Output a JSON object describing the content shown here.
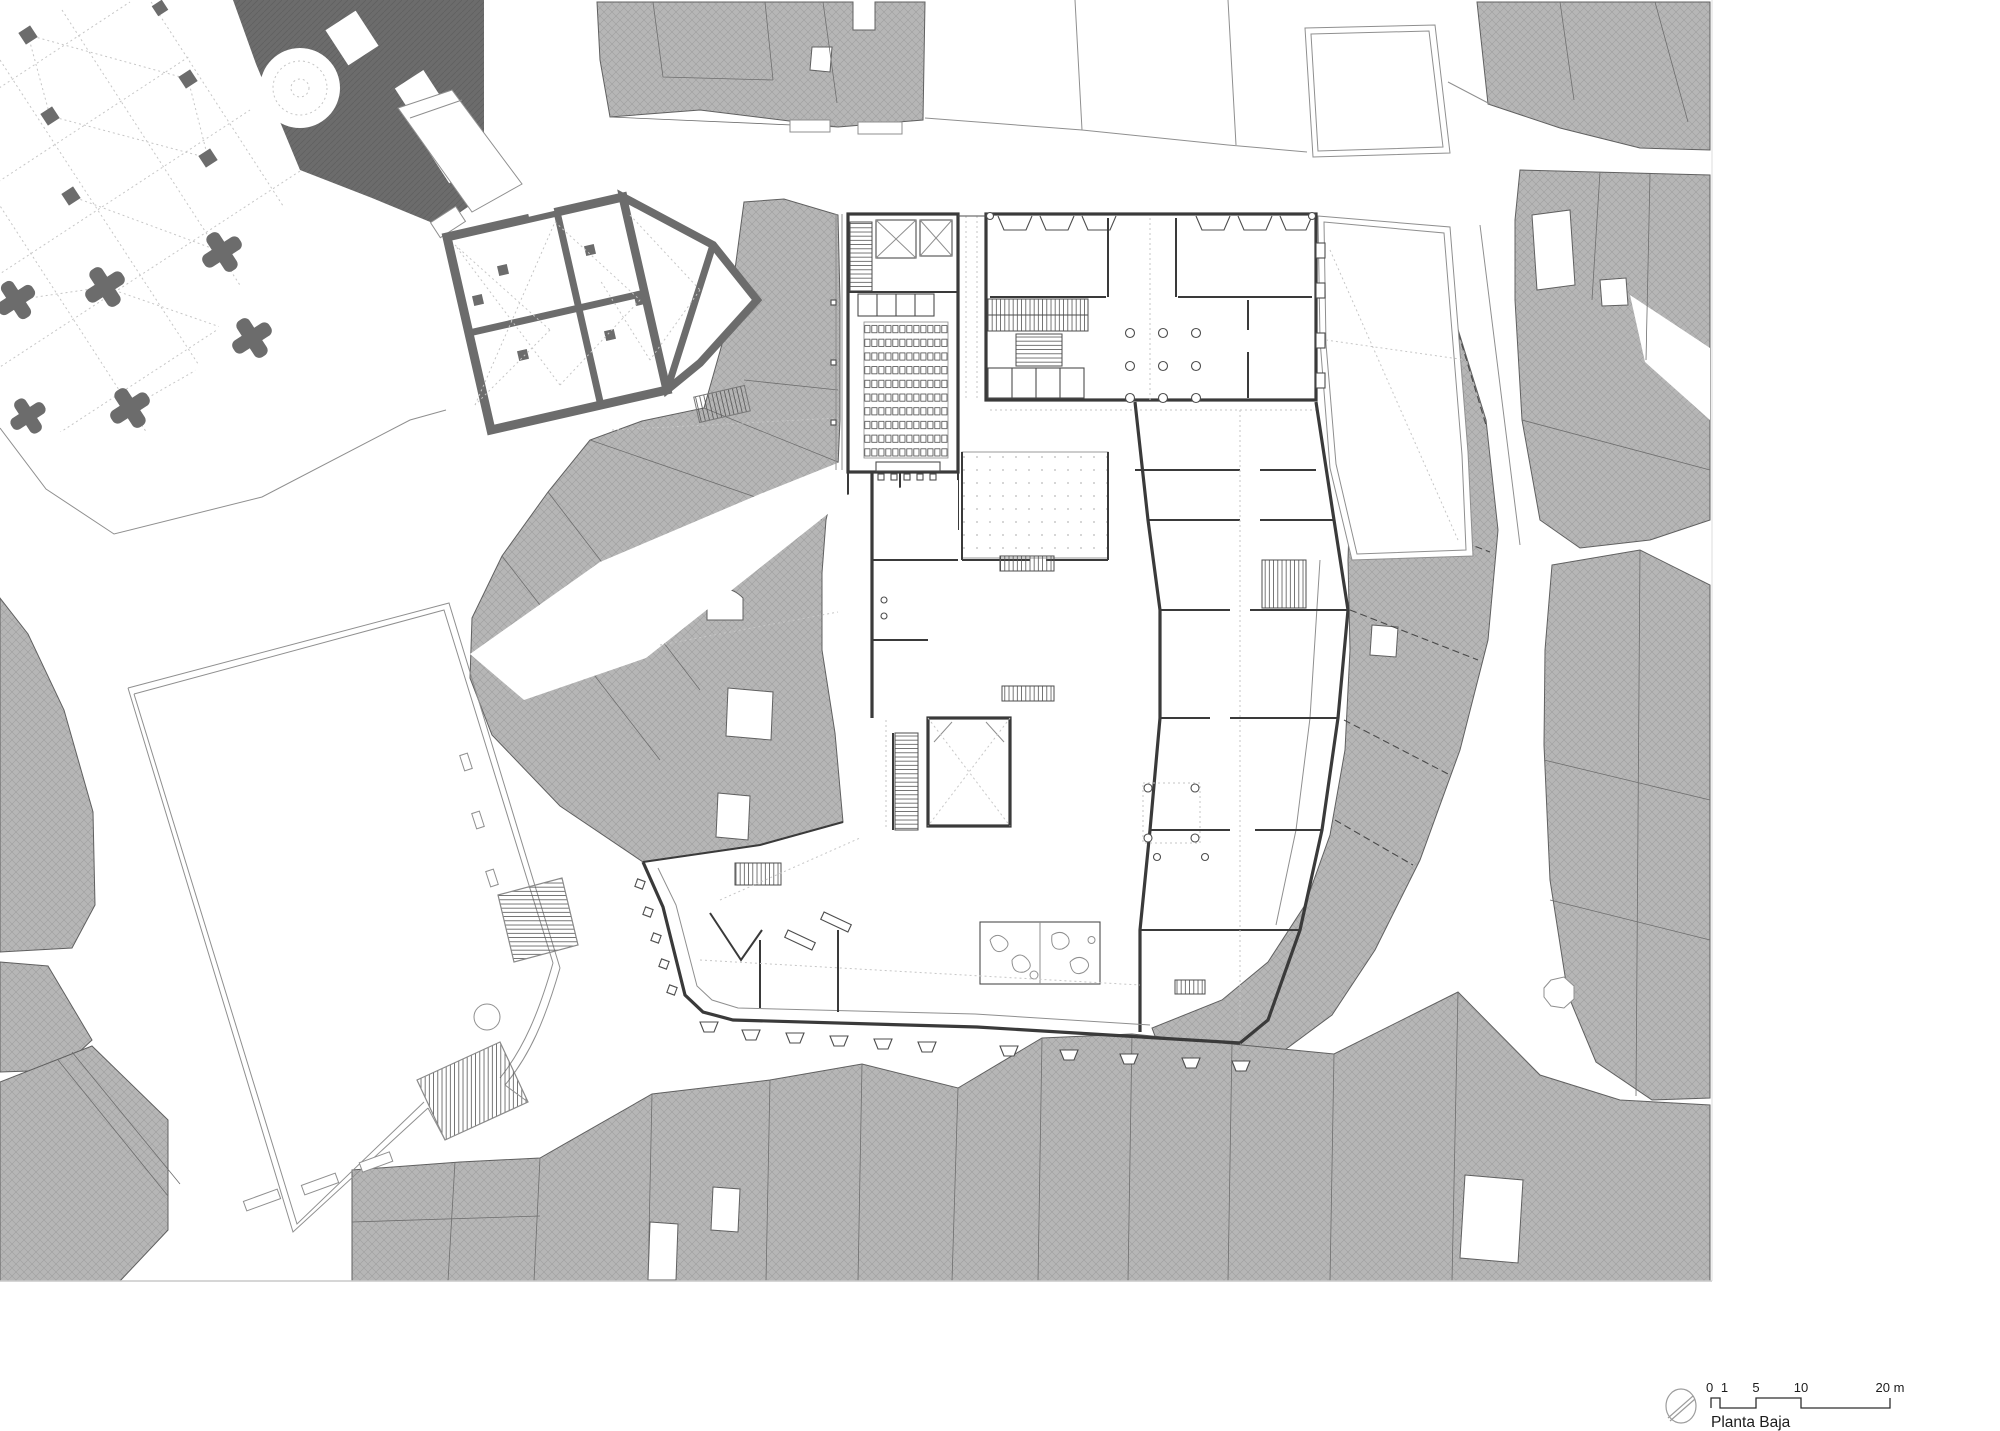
{
  "drawing": {
    "caption": "Planta Baja",
    "type": "architectural-site-plan"
  },
  "legend": {
    "scale_bar": {
      "tick_labels": [
        "0 1",
        "5",
        "10",
        "20 m"
      ],
      "total_meters": 20,
      "unit": "m"
    },
    "north_icon": "north-arrow-icon"
  },
  "colors": {
    "paper": "#ffffff",
    "block-fill": "#b6b6b6",
    "block-hatch": "#9e9e9e",
    "block-outline": "#606060",
    "poche-fill": "#6c6c6c",
    "poche-hatch": "#5e5e5e",
    "wall-dark": "#3a3a3a",
    "line-mid": "#8f8f8f",
    "line-light": "#c6c6c6",
    "text": "#1c1c1c"
  }
}
